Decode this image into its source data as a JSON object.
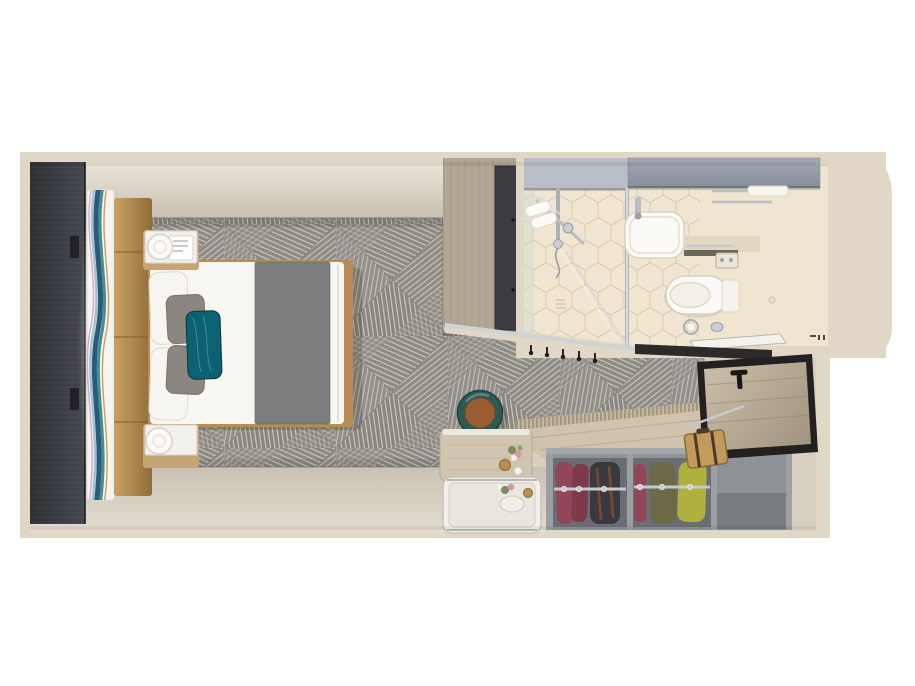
{
  "meta": {
    "description": "Top-down 3D rendered floor plan of a cruise-ship stateroom with bedroom, bathroom, entry and open wardrobe",
    "width_px": 915,
    "height_px": 686
  },
  "palette": {
    "page_bg": "#ffffff",
    "wall": "#e0d7c7",
    "floor": "#d7cfc1",
    "floor_light": "#e9e3d7",
    "carpet": "#8e8b85",
    "carpet_line": "#cdc9c2",
    "dark_panel": "#33363c",
    "headboard": "#b08549",
    "artwork_blue": "#2e5a78",
    "artwork_teal": "#3e8f96",
    "bed_linen": "#f7f6f1",
    "bed_frame_wood": "#b98d52",
    "bed_runner": "#7b7d7f",
    "pillow_gray": "#8b8780",
    "pillow_teal": "#0d6272",
    "marble": "#f2f0ea",
    "lamp": "#fbfaf6",
    "cabinet_wood": "#b2a694",
    "cabinet_door": "#3a3c41",
    "bath_floor": "#efe5d0",
    "tile_line": "#d8caae",
    "cabinet_silver": "#b7bec6",
    "cabinet_gray": "#929ca7",
    "chrome": "#b9bec4",
    "fixture": "#fbfaf6",
    "mirror": "#ccd4d4",
    "threshold": "#2c2b29",
    "door_frame": "#22211f",
    "door_wood": "#c0b29c",
    "closet": "#8f9296",
    "closet_dark": "#6a6d71",
    "garment_maroon": "#92465a",
    "garment_maroon_dark": "#7c3a4a",
    "garment_dark": "#3a393f",
    "garment_olive": "#6b6946",
    "garment_chartreuse": "#aeb13e",
    "counter": "#cfc3ab",
    "suitcase": "#c19a5c",
    "stool_teal": "#2c5a55",
    "stool_leather": "#9a5c31",
    "tray": "#f1efe9"
  },
  "rooms": {
    "bedroom": {
      "items": [
        "dark-wardrobe-panel",
        "wave-artwork",
        "upholstered-headboard",
        "double-bed",
        "white-pillows",
        "gray-pillows",
        "teal-accent-pillow",
        "gray-bed-runner",
        "nightstand",
        "table-lamp",
        "patterned-carpet",
        "desk",
        "round-stool",
        "serving-tray-table",
        "flower-vase"
      ]
    },
    "bathroom": {
      "items": [
        "shower",
        "glass-partition",
        "rolled-towels",
        "wash-basin",
        "faucet",
        "vanity-counter",
        "toilet",
        "flush-plate",
        "toilet-paper-holder",
        "towel-rack",
        "hexagon-tile-floor",
        "overhead-cabinet"
      ]
    },
    "entry": {
      "items": [
        "entrance-door",
        "door-handle",
        "tall-cabinet",
        "coat-hooks",
        "threshold-mat",
        "suitcase",
        "grab-rail"
      ]
    },
    "closet": {
      "items": [
        "wardrobe-counter",
        "vent-grille",
        "hanging-rail",
        "maroon-garments",
        "dark-jacket",
        "olive-garment",
        "chartreuse-garment",
        "empty-compartment"
      ]
    }
  }
}
